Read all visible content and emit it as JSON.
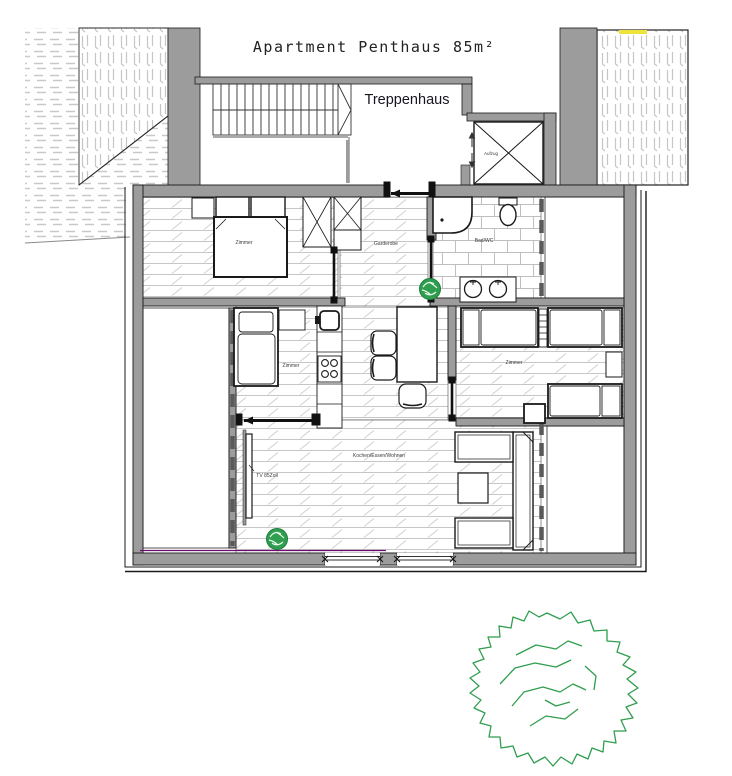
{
  "labels": {
    "title": "Apartment Penthaus 85m²",
    "staircase": "Treppenhaus",
    "elevator": "Aufzug",
    "bedroom_main": "Zimmer",
    "hallway": "Garderobe",
    "bathroom": "Bad/WC",
    "bedroom_small": "Zimmer",
    "bedroom_right": "Zimmer",
    "living_kitchen": "Kochen/Essen/Wohnen",
    "tv": "TV 85Zoll"
  },
  "colors": {
    "wall_gray": "#9c9c9c",
    "outline_black": "#1a1a1a",
    "hatch_gray": "#c9c9c9",
    "plant_green": "#2f9e4e",
    "roof_marker_yellow": "#efe33b",
    "accent_magenta": "#6e0b6e"
  }
}
